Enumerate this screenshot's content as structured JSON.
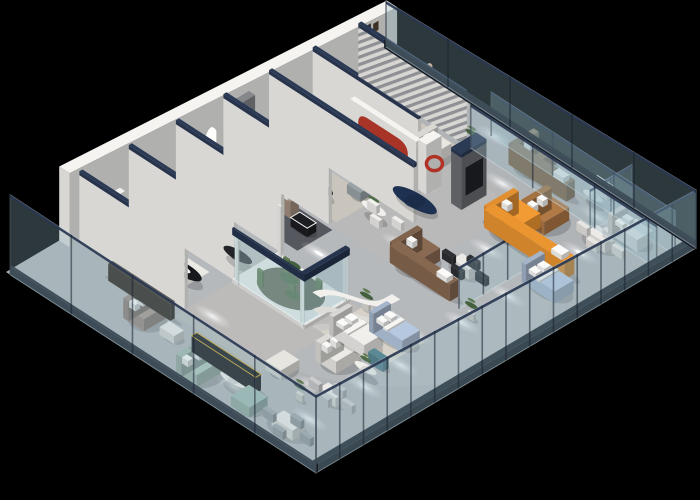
{
  "meta": {
    "description": "3D isometric cutaway rendering of a furniture showroom floor plan on a black background",
    "canvas": {
      "w": 700,
      "h": 500
    },
    "background": "#000000"
  },
  "projection": {
    "ox": 6,
    "oy": 272,
    "ux": 0.38,
    "uy": -0.225,
    "vx": 1.0333,
    "vy": 0.67
  },
  "palette": {
    "floor": "#b1b4b7",
    "wall": "#f5f4f1",
    "wall_cap_navy": "#2b3a55",
    "glass": "rgba(150,185,200,0.30)",
    "glass_edge": "rgba(215,235,242,0.45)",
    "plinth": "#1a212c",
    "accent_orange": "#e8892b",
    "accent_coral": "#c4604a",
    "accent_teal": "#5f8fa3",
    "accent_mint": "#adc4ba",
    "accent_navy": "#1e3150",
    "accent_red": "#a83428",
    "leather_brown": "#8a6a52",
    "caramel": "#b07946",
    "bed_blue": "#b6c8e0"
  },
  "building": {
    "length": 1000,
    "depth": 300,
    "floor_color": "#b1b4b7"
  },
  "lights": {
    "pools": [
      [
        70,
        195
      ],
      [
        105,
        255
      ],
      [
        190,
        130
      ],
      [
        235,
        60
      ],
      [
        250,
        255
      ],
      [
        320,
        90
      ],
      [
        345,
        255
      ],
      [
        360,
        160
      ],
      [
        430,
        60
      ],
      [
        470,
        130
      ],
      [
        520,
        250
      ],
      [
        560,
        60
      ],
      [
        600,
        160
      ],
      [
        640,
        250
      ],
      [
        700,
        60
      ],
      [
        710,
        205
      ],
      [
        760,
        120
      ],
      [
        810,
        60
      ],
      [
        830,
        250
      ],
      [
        870,
        160
      ],
      [
        905,
        60
      ],
      [
        930,
        230
      ],
      [
        960,
        120
      ],
      [
        430,
        235
      ],
      [
        180,
        232
      ],
      [
        985,
        70
      ]
    ],
    "hot": [
      [
        235,
        60
      ],
      [
        360,
        160
      ],
      [
        560,
        60
      ],
      [
        700,
        60
      ],
      [
        810,
        60
      ],
      [
        905,
        60
      ],
      [
        470,
        130
      ],
      [
        830,
        250
      ]
    ]
  },
  "items": [
    {
      "t": "patch",
      "name": "floor-tone-left",
      "x": 140,
      "y": 112,
      "w": 270,
      "d": 85,
      "c": "#c3bfb7",
      "o": 0.45
    },
    {
      "t": "patch",
      "name": "floor-tone-right",
      "x": 545,
      "y": 112,
      "w": 310,
      "d": 75,
      "c": "#bcb9b2",
      "o": 0.35
    },
    {
      "t": "rug",
      "name": "rug-room1",
      "x": 178,
      "y": 18,
      "w": 102,
      "d": 76,
      "c": "#ebe9e4"
    },
    {
      "t": "rug",
      "name": "rug-arches-room",
      "x": 446,
      "y": 22,
      "w": 92,
      "d": 96,
      "c": "#55585e"
    },
    {
      "t": "rug",
      "name": "rug-teal-room",
      "x": 560,
      "y": 26,
      "w": 100,
      "d": 88,
      "c": "#c9c5bd"
    },
    {
      "t": "rug",
      "name": "rug-coral-room",
      "x": 792,
      "y": 24,
      "w": 96,
      "d": 88,
      "c": "#cec7bb"
    },
    {
      "t": "rug",
      "name": "rug-bed-zone",
      "x": 306,
      "y": 192,
      "w": 120,
      "d": 56,
      "c": "#d6d2c9"
    },
    {
      "t": "wall",
      "name": "back-wall",
      "x": 140,
      "y": 0,
      "w": 862,
      "d": 10,
      "h": 74,
      "h2": 46
    },
    {
      "t": "wall",
      "name": "partition-1",
      "x": 166,
      "y": 10,
      "w": 8,
      "d": 102,
      "h": 66,
      "cap": true
    },
    {
      "t": "wall",
      "name": "partition-2",
      "x": 296,
      "y": 10,
      "w": 8,
      "d": 102,
      "h": 63,
      "cap": true
    },
    {
      "t": "wall",
      "name": "partition-3",
      "x": 420,
      "y": 10,
      "w": 8,
      "d": 102,
      "h": 60,
      "cap": true
    },
    {
      "t": "wall",
      "name": "partition-4",
      "x": 545,
      "y": 10,
      "w": 8,
      "d": 102,
      "h": 58,
      "cap": true
    },
    {
      "t": "wall",
      "name": "partition-5",
      "x": 665,
      "y": 10,
      "w": 8,
      "d": 140,
      "h": 55,
      "cap": true
    },
    {
      "t": "wall",
      "name": "partition-6",
      "x": 780,
      "y": 10,
      "w": 8,
      "d": 102,
      "h": 52,
      "cap": true
    },
    {
      "t": "wall-striped",
      "name": "slat-partition",
      "x": 900,
      "y": 10,
      "w": 8,
      "d": 102,
      "h": 49
    },
    {
      "t": "wall",
      "name": "tv-panel-gray",
      "x": 560,
      "y": 10,
      "w": 52,
      "d": 6,
      "h": 50,
      "c": "#85878b",
      "screen": true
    },
    {
      "t": "wall",
      "name": "media-wall-dark",
      "x": 758,
      "y": 152,
      "w": 66,
      "d": 10,
      "h": 52,
      "c": "#6b6d71",
      "screen": true,
      "cap": true
    },
    {
      "t": "wall-red-arch",
      "name": "red-arch-wall",
      "x": 726,
      "y": 66,
      "w": 12,
      "d": 64,
      "h": 54
    },
    {
      "t": "wall-ring",
      "name": "red-ring-wall",
      "x": 742,
      "y": 126,
      "w": 40,
      "d": 8,
      "h": 50
    },
    {
      "t": "box",
      "name": "display-ledge",
      "x": 186,
      "y": 11,
      "w": 84,
      "d": 5,
      "z": 26,
      "h": 5,
      "c": "#f2f1ee"
    },
    {
      "t": "arches",
      "name": "arch-lightboxes",
      "y": 10,
      "xs": [
        430,
        464,
        498
      ],
      "w": 26,
      "zh": 30,
      "rise": 12
    },
    {
      "t": "posters",
      "name": "poster-wall",
      "y": 10,
      "rects": [
        {
          "x": 916,
          "w": 16,
          "z0": 18,
          "z1": 46,
          "c": "#2c2c31"
        },
        {
          "x": 938,
          "w": 14,
          "z0": 16,
          "z1": 44,
          "c": "#c8a28e"
        }
      ]
    },
    {
      "t": "terrarium",
      "name": "plant-terrarium",
      "x": 290,
      "y": 115,
      "w": 115,
      "d": 66,
      "h": 54
    },
    {
      "t": "curved-wall",
      "name": "curved-partition",
      "h": 34
    },
    {
      "t": "glass-run",
      "name": "glass-facade-front",
      "axis": "x",
      "x": 0,
      "y": 300,
      "len": 1000,
      "h": 78,
      "h2": 58,
      "mullions": 16,
      "plinth": true
    },
    {
      "t": "glass-run",
      "name": "glass-facade-left",
      "axis": "y",
      "x": 0,
      "y": 4,
      "len": 296,
      "h": 80,
      "h2": 78,
      "mullions": 5,
      "plinth": true
    },
    {
      "t": "glass-run",
      "name": "glass-facade-right",
      "axis": "y",
      "x": 1000,
      "y": 0,
      "len": 300,
      "h": 46,
      "h2": 58,
      "mullions": 5,
      "plinth": true
    },
    {
      "t": "glass-run",
      "name": "glass-partition-a",
      "axis": "x",
      "x": 545,
      "y": 238,
      "len": 192,
      "h": 42,
      "h2": 42,
      "mullions": 3
    },
    {
      "t": "glass-run",
      "name": "glass-partition-b",
      "axis": "x",
      "x": 890,
      "y": 238,
      "len": 110,
      "h": 42,
      "h2": 42,
      "mullions": 2
    },
    {
      "t": "glass-run",
      "name": "glass-partition-c",
      "axis": "y",
      "x": 902,
      "y": 118,
      "len": 180,
      "h": 44,
      "h2": 44,
      "mullions": 3
    },
    {
      "t": "glass-run",
      "name": "glass-partition-d",
      "axis": "y",
      "x": 956,
      "y": 118,
      "len": 178,
      "h": 44,
      "h2": 44,
      "mullions": 3
    },
    {
      "t": "sofa",
      "name": "mint-sofa",
      "x": 18,
      "y": 158,
      "w": 74,
      "d": 20,
      "h": 12,
      "c": "#adc4ba"
    },
    {
      "t": "box",
      "name": "mint-bench",
      "x": 26,
      "y": 208,
      "w": 48,
      "d": 18,
      "h": 10,
      "c": "#9db8ae",
      "shadow": true
    },
    {
      "t": "disk",
      "name": "side-table-mint",
      "x": 66,
      "y": 196,
      "r": 12,
      "h": 9,
      "c": "#efeeea",
      "plant": true
    },
    {
      "t": "dining",
      "name": "dining-set-left",
      "x": 36,
      "y": 244,
      "w": 32,
      "d": 20,
      "h": 10,
      "c": "#eceae7",
      "cc": "#9fa4a8"
    },
    {
      "t": "box",
      "name": "black-sideboard",
      "x": 86,
      "y": 148,
      "w": 14,
      "d": 62,
      "h": 16,
      "c": "#141519",
      "trim": "#c9a227",
      "shadow": true
    },
    {
      "t": "sofa",
      "name": "taupe-sofa",
      "x": 64,
      "y": 90,
      "w": 56,
      "d": 20,
      "h": 12,
      "c": "#a6948a"
    },
    {
      "t": "box",
      "name": "coffee-table-white-a",
      "x": 78,
      "y": 120,
      "w": 26,
      "d": 14,
      "h": 8,
      "c": "#eceae7",
      "shadow": true
    },
    {
      "t": "box",
      "name": "walnut-console",
      "x": 122,
      "y": 54,
      "w": 12,
      "d": 60,
      "h": 17,
      "c": "#30271f",
      "shadow": true
    },
    {
      "t": "sofa",
      "name": "orange-arm-sofa",
      "x": 194,
      "y": 32,
      "w": 80,
      "d": 24,
      "h": 13,
      "c": "#e4e1da",
      "arms": true,
      "armc": "#d97f4e"
    },
    {
      "t": "disk",
      "name": "black-round-table",
      "x": 232,
      "y": 86,
      "r": 17,
      "h": 8,
      "c": "#17181c",
      "tray": true
    },
    {
      "t": "lsofa",
      "name": "white-l-sofa-a",
      "x": 318,
      "y": 36,
      "w": 72,
      "d": 20,
      "rx": 318,
      "ry": 36,
      "rw": 20,
      "rd": 58,
      "h": 12,
      "c": "#e9e7e2"
    },
    {
      "t": "box",
      "name": "coffee-table-white-b",
      "x": 350,
      "y": 76,
      "w": 22,
      "d": 14,
      "h": 8,
      "c": "#eceae7",
      "shadow": true
    },
    {
      "t": "disk",
      "name": "dark-oval-table-a",
      "x": 338,
      "y": 100,
      "r": 13,
      "h": 8,
      "c": "#222428"
    },
    {
      "t": "box",
      "name": "orange-counter",
      "x": 426,
      "y": 26,
      "w": 20,
      "d": 48,
      "h": 20,
      "c": "#e8892b",
      "shadow": true
    },
    {
      "t": "lsofa",
      "name": "taupe-l-sectional",
      "x": 452,
      "y": 28,
      "w": 74,
      "d": 22,
      "rx": 504,
      "ry": 28,
      "rw": 22,
      "rd": 62,
      "h": 13,
      "c": "#a89383"
    },
    {
      "t": "box",
      "name": "bw-coffee-table-a",
      "x": 458,
      "y": 72,
      "w": 24,
      "d": 16,
      "h": 9,
      "c": "#1d1e22",
      "trim": "#f4f4f2",
      "shadow": true
    },
    {
      "t": "box",
      "name": "bw-coffee-table-b",
      "x": 488,
      "y": 96,
      "w": 24,
      "d": 16,
      "h": 9,
      "c": "#1d1e22",
      "trim": "#f4f4f2",
      "shadow": true
    },
    {
      "t": "sofa",
      "name": "teal-sofa",
      "x": 568,
      "y": 32,
      "w": 72,
      "d": 22,
      "h": 13,
      "c": "#5f8fa3",
      "pillowc": "#d97f3e"
    },
    {
      "t": "disk",
      "name": "black-oval-table-b",
      "x": 594,
      "y": 82,
      "r": 15,
      "h": 8,
      "c": "#1b1d21"
    },
    {
      "t": "box",
      "name": "gray-bench",
      "x": 636,
      "y": 96,
      "w": 34,
      "d": 13,
      "h": 9,
      "c": "#99a2a7",
      "shadow": true
    },
    {
      "t": "disk",
      "name": "bistro-table",
      "x": 620,
      "y": 128,
      "r": 11,
      "h": 10,
      "c": "#f0efec",
      "plant": true,
      "chairs": 3
    },
    {
      "t": "lsofa",
      "name": "white-l-sofa-b",
      "x": 678,
      "y": 32,
      "w": 70,
      "d": 20,
      "rx": 678,
      "ry": 32,
      "rw": 20,
      "rd": 56,
      "h": 12,
      "c": "#ebe9e4"
    },
    {
      "t": "box",
      "name": "coffee-table-gray",
      "x": 710,
      "y": 72,
      "w": 22,
      "d": 14,
      "h": 8,
      "c": "#b9bcbe",
      "shadow": true
    },
    {
      "t": "disk",
      "name": "navy-round-table",
      "x": 706,
      "y": 136,
      "r": 20,
      "h": 4,
      "c": "#1e3150"
    },
    {
      "t": "sofa",
      "name": "coral-sofa",
      "x": 798,
      "y": 30,
      "w": 72,
      "d": 22,
      "h": 13,
      "c": "#c4604a"
    },
    {
      "t": "disk",
      "name": "black-oval-table-c",
      "x": 824,
      "y": 78,
      "r": 15,
      "h": 8,
      "c": "#1b1d21"
    },
    {
      "t": "sofa",
      "name": "white-sofa-coral-room",
      "x": 798,
      "y": 96,
      "w": 64,
      "d": 18,
      "h": 11,
      "c": "#e9e7e2"
    },
    {
      "t": "sofa",
      "name": "orange-showroom-sofa",
      "x": 914,
      "y": 28,
      "w": 62,
      "d": 20,
      "h": 12,
      "c": "#f09a2e"
    },
    {
      "t": "disk",
      "name": "side-table-end-room",
      "x": 946,
      "y": 64,
      "r": 9,
      "h": 8,
      "c": "#efeeea"
    },
    {
      "t": "person",
      "name": "person-figure",
      "x": 962,
      "y": 56
    },
    {
      "t": "box",
      "name": "white-bench",
      "x": 150,
      "y": 196,
      "w": 48,
      "d": 15,
      "h": 9,
      "c": "#e7e5e0",
      "shadow": true
    },
    {
      "t": "dining",
      "name": "dining-set-front-left",
      "x": 166,
      "y": 242,
      "w": 24,
      "d": 16,
      "h": 9,
      "c": "#eceae7",
      "cc": "#caccce"
    },
    {
      "t": "sofa",
      "name": "white-sofa-front",
      "x": 238,
      "y": 212,
      "w": 62,
      "d": 20,
      "h": 12,
      "c": "#edebe7"
    },
    {
      "t": "box",
      "name": "teal-ottoman",
      "x": 306,
      "y": 238,
      "w": 16,
      "d": 14,
      "h": 11,
      "c": "#5b8a96",
      "shadow": true
    },
    {
      "t": "disk",
      "name": "side-table-front",
      "x": 272,
      "y": 248,
      "r": 10,
      "h": 9,
      "c": "#efeeea",
      "plant": true
    },
    {
      "t": "bed",
      "name": "white-bed",
      "x": 312,
      "y": 198,
      "w": 50,
      "d": 34,
      "h": 12,
      "c": "#f0efec"
    },
    {
      "t": "bed",
      "name": "blue-bed-a",
      "x": 374,
      "y": 214,
      "w": 46,
      "d": 32,
      "h": 12,
      "c": "#b6c8e0"
    },
    {
      "t": "lsofa",
      "name": "brown-leather-sectional",
      "x": 548,
      "y": 170,
      "w": 72,
      "d": 22,
      "rx": 548,
      "ry": 170,
      "rw": 22,
      "rd": 58,
      "h": 13,
      "c": "#8a6a52"
    },
    {
      "t": "dining",
      "name": "dining-set-dark-chairs",
      "x": 620,
      "y": 204,
      "w": 26,
      "d": 16,
      "h": 10,
      "c": "#eceae7",
      "cc": "#2e3034"
    },
    {
      "t": "bed",
      "name": "blue-bed-b",
      "x": 688,
      "y": 246,
      "w": 50,
      "d": 32,
      "h": 12,
      "c": "#b6c8e0"
    },
    {
      "t": "lsofa",
      "name": "orange-l-sectional",
      "x": 752,
      "y": 186,
      "w": 78,
      "d": 26,
      "rx": 752,
      "ry": 186,
      "rw": 26,
      "rd": 78,
      "h": 14,
      "c": "#f29a33"
    },
    {
      "t": "sofa",
      "name": "caramel-sofa",
      "x": 818,
      "y": 198,
      "w": 66,
      "d": 22,
      "h": 13,
      "c": "#b07946"
    },
    {
      "t": "dining",
      "name": "dining-set-right",
      "x": 864,
      "y": 244,
      "w": 28,
      "d": 18,
      "h": 10,
      "c": "#eceae7",
      "cc": "#e8e6e2"
    },
    {
      "t": "bed",
      "name": "white-bed-b",
      "x": 910,
      "y": 248,
      "w": 42,
      "d": 28,
      "h": 12,
      "c": "#f0efec"
    },
    {
      "t": "lsofa",
      "name": "brown-l-sofa-right",
      "x": 920,
      "y": 148,
      "w": 66,
      "d": 22,
      "rx": 920,
      "ry": 148,
      "rw": 22,
      "rd": 56,
      "h": 13,
      "c": "#8d7155"
    },
    {
      "t": "box",
      "name": "white-armchair",
      "x": 978,
      "y": 206,
      "w": 18,
      "d": 16,
      "h": 11,
      "c": "#f0efec",
      "shadow": true
    },
    {
      "t": "disk",
      "name": "round-table-right",
      "x": 952,
      "y": 218,
      "r": 9,
      "h": 8,
      "c": "#efeeea"
    },
    {
      "t": "plant",
      "name": "plant-a",
      "x": 416,
      "y": 196
    },
    {
      "t": "plant",
      "name": "plant-b",
      "x": 540,
      "y": 252
    },
    {
      "t": "plant",
      "name": "plant-c",
      "x": 132,
      "y": 236
    },
    {
      "t": "plant",
      "name": "plant-d",
      "x": 906,
      "y": 118
    }
  ]
}
